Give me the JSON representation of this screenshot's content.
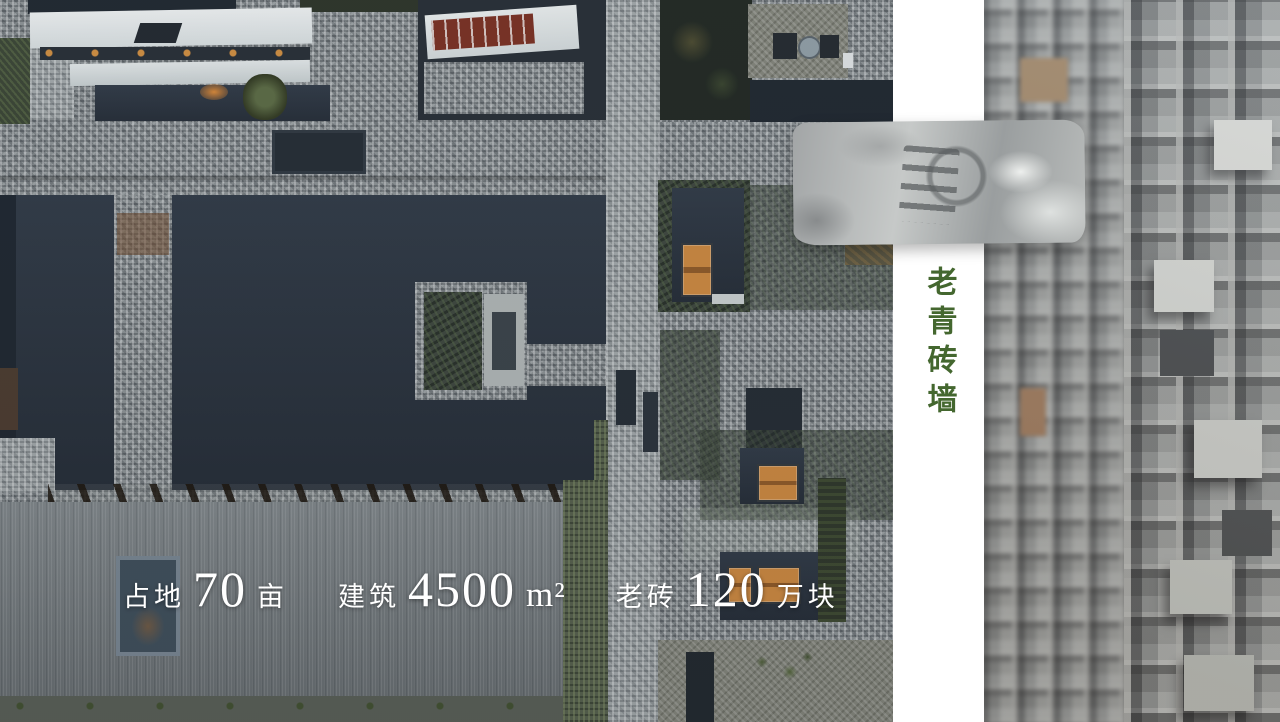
{
  "label_panel": {
    "text": "老青砖墙",
    "color": "#44672f"
  },
  "stats": {
    "text_color": "#ffffff",
    "items": [
      {
        "prefix": "占地",
        "value": "70",
        "unit": "亩"
      },
      {
        "prefix": "建筑",
        "value": "4500",
        "unit": "m²"
      },
      {
        "prefix": "老砖",
        "value": "120",
        "unit": "万块"
      }
    ]
  },
  "colors": {
    "accent_green": "#44672f",
    "window_orange": "#d28a3e"
  }
}
